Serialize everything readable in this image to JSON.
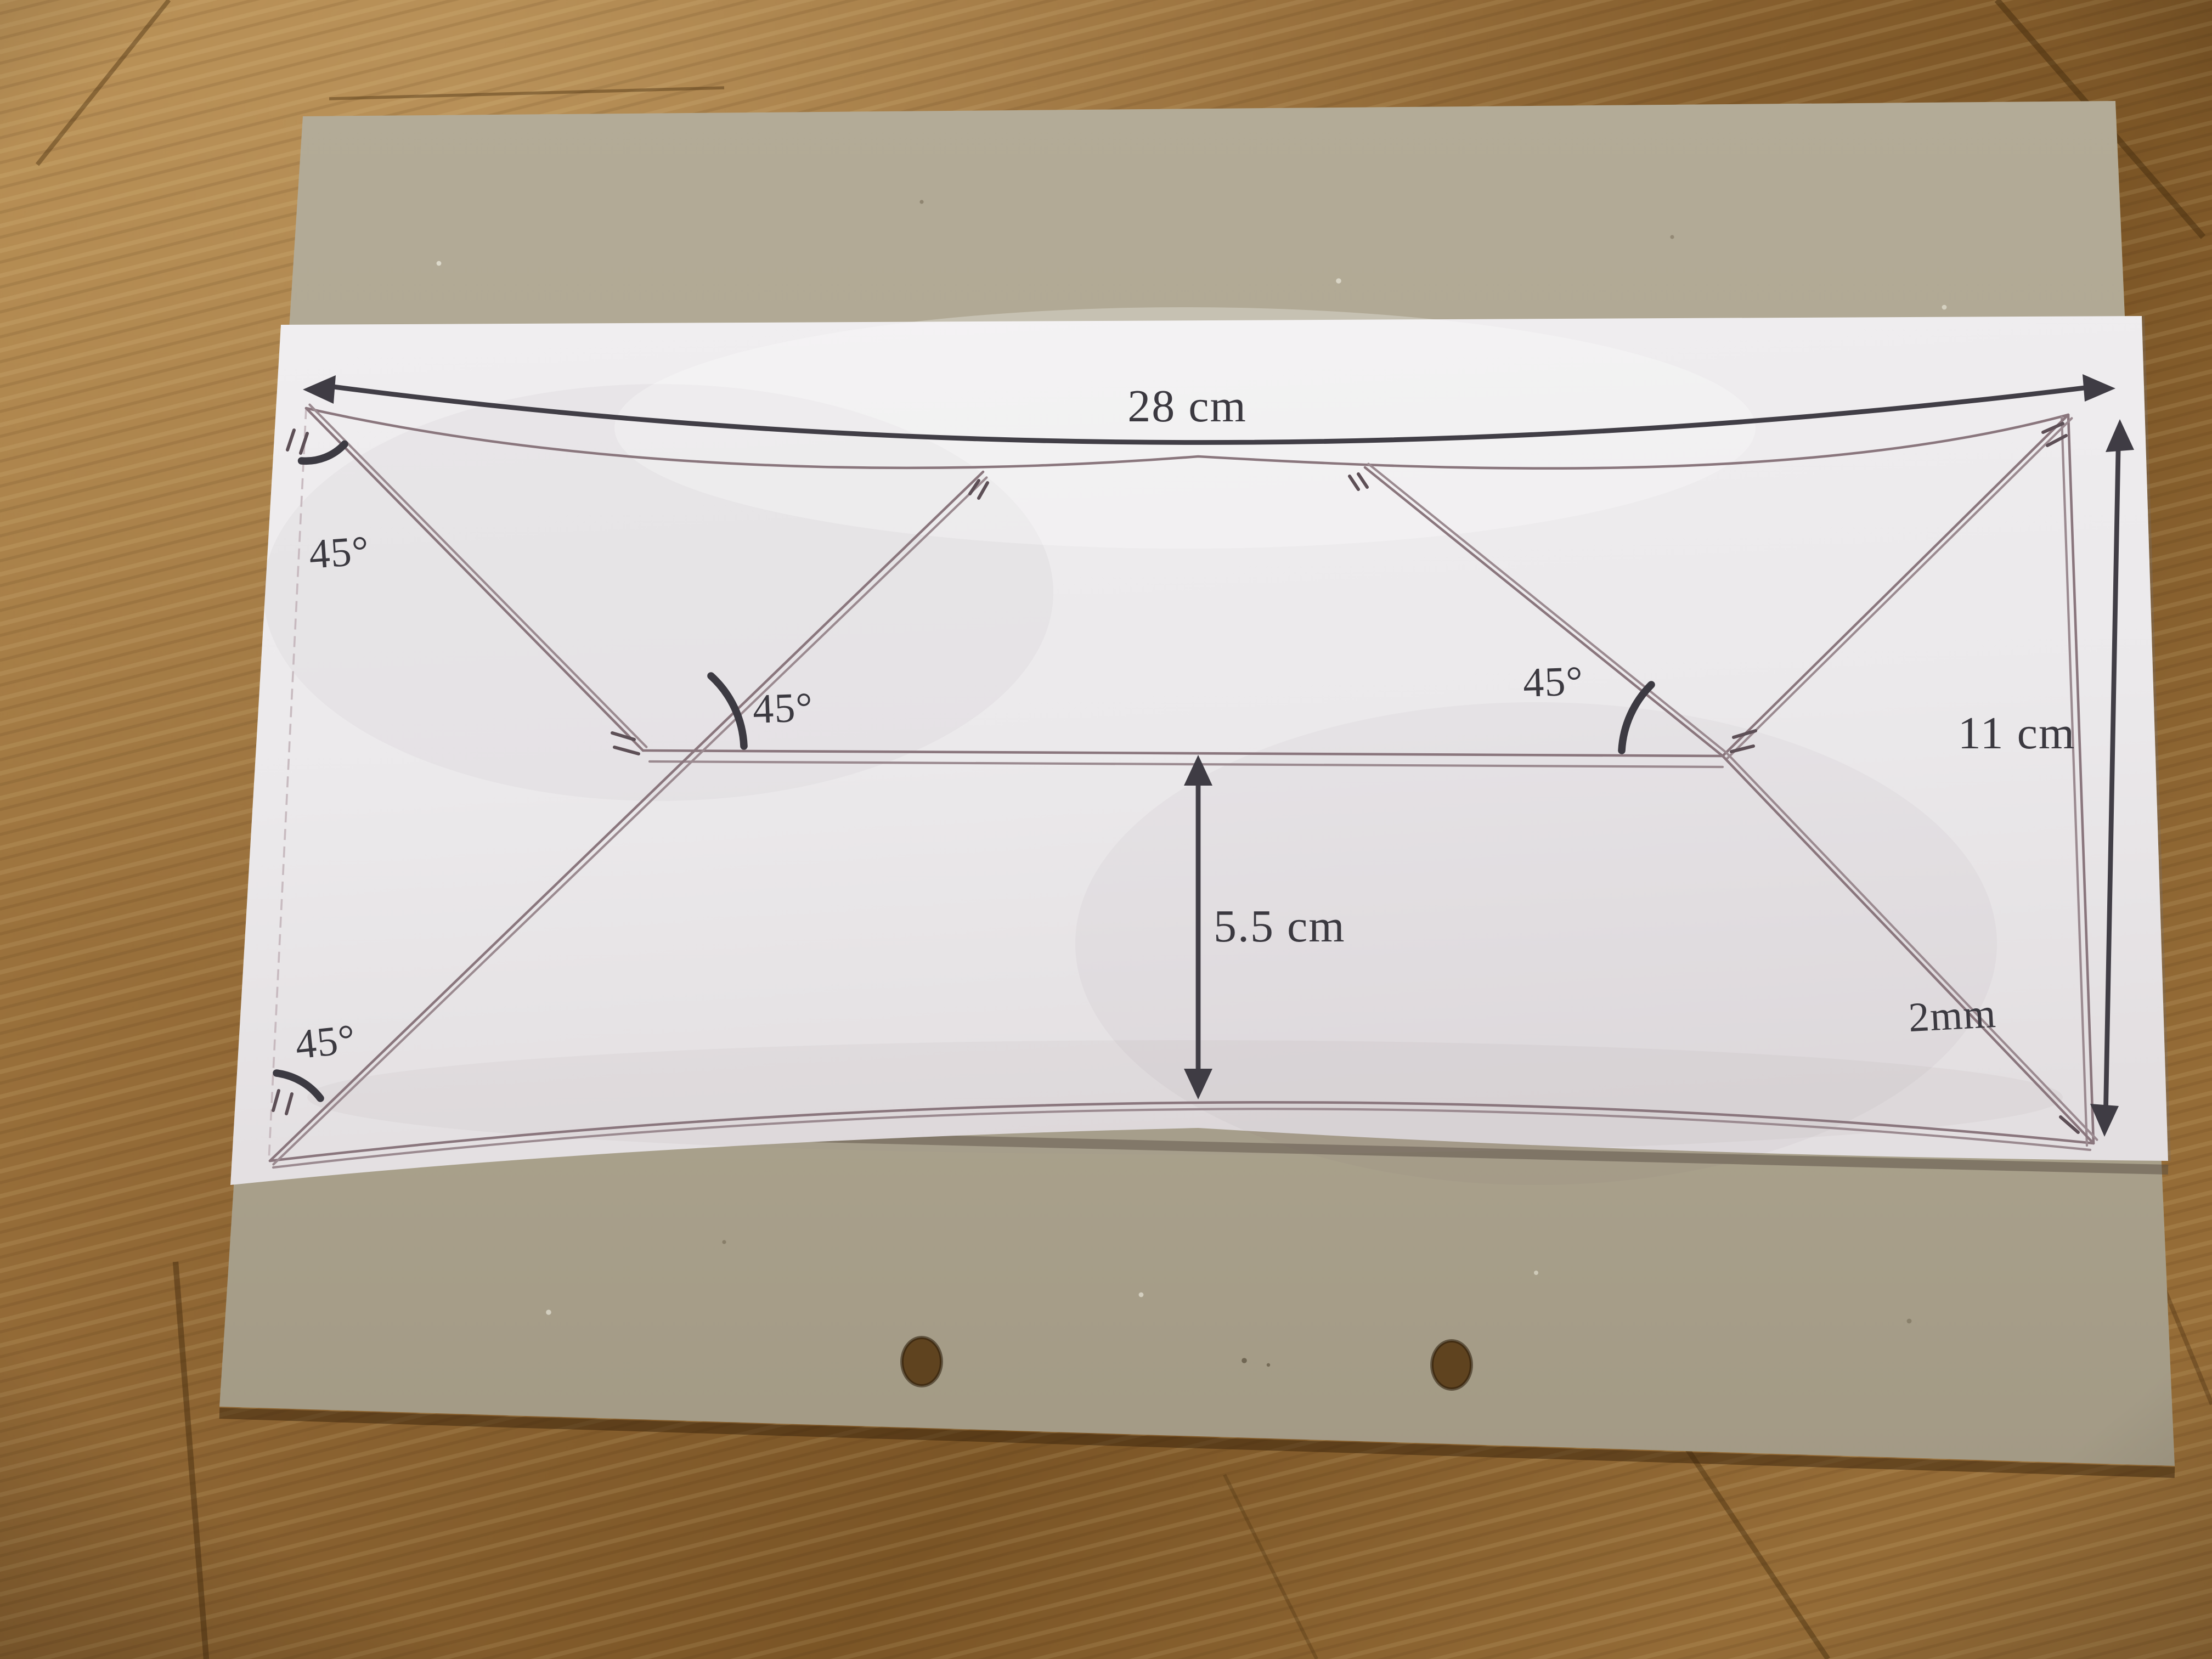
{
  "scene": {
    "type": "photo-of-technical-drawing",
    "colors": {
      "wood": "#8a6132",
      "cardboard": "#aca58f",
      "paper": "#edebec",
      "pencil_line": "#8a767d",
      "ink": "#3f3c44"
    }
  },
  "diagram": {
    "shape": "box-net rectangle with 45-degree mitre flap diagonals and half-height fold line",
    "labels": {
      "width_top": "28 cm",
      "height_right": "11 cm",
      "height_middle": "5.5 cm",
      "line_gap": "2mm",
      "angle_top_left": "45°",
      "angle_mid_left": "45°",
      "angle_mid_right": "45°",
      "angle_bottom_left": "45°"
    },
    "dimensions": {
      "width_cm": 28,
      "height_cm": 11,
      "mid_height_cm": 5.5,
      "double_line_gap_mm": 2,
      "flap_angle_deg": 45
    }
  }
}
